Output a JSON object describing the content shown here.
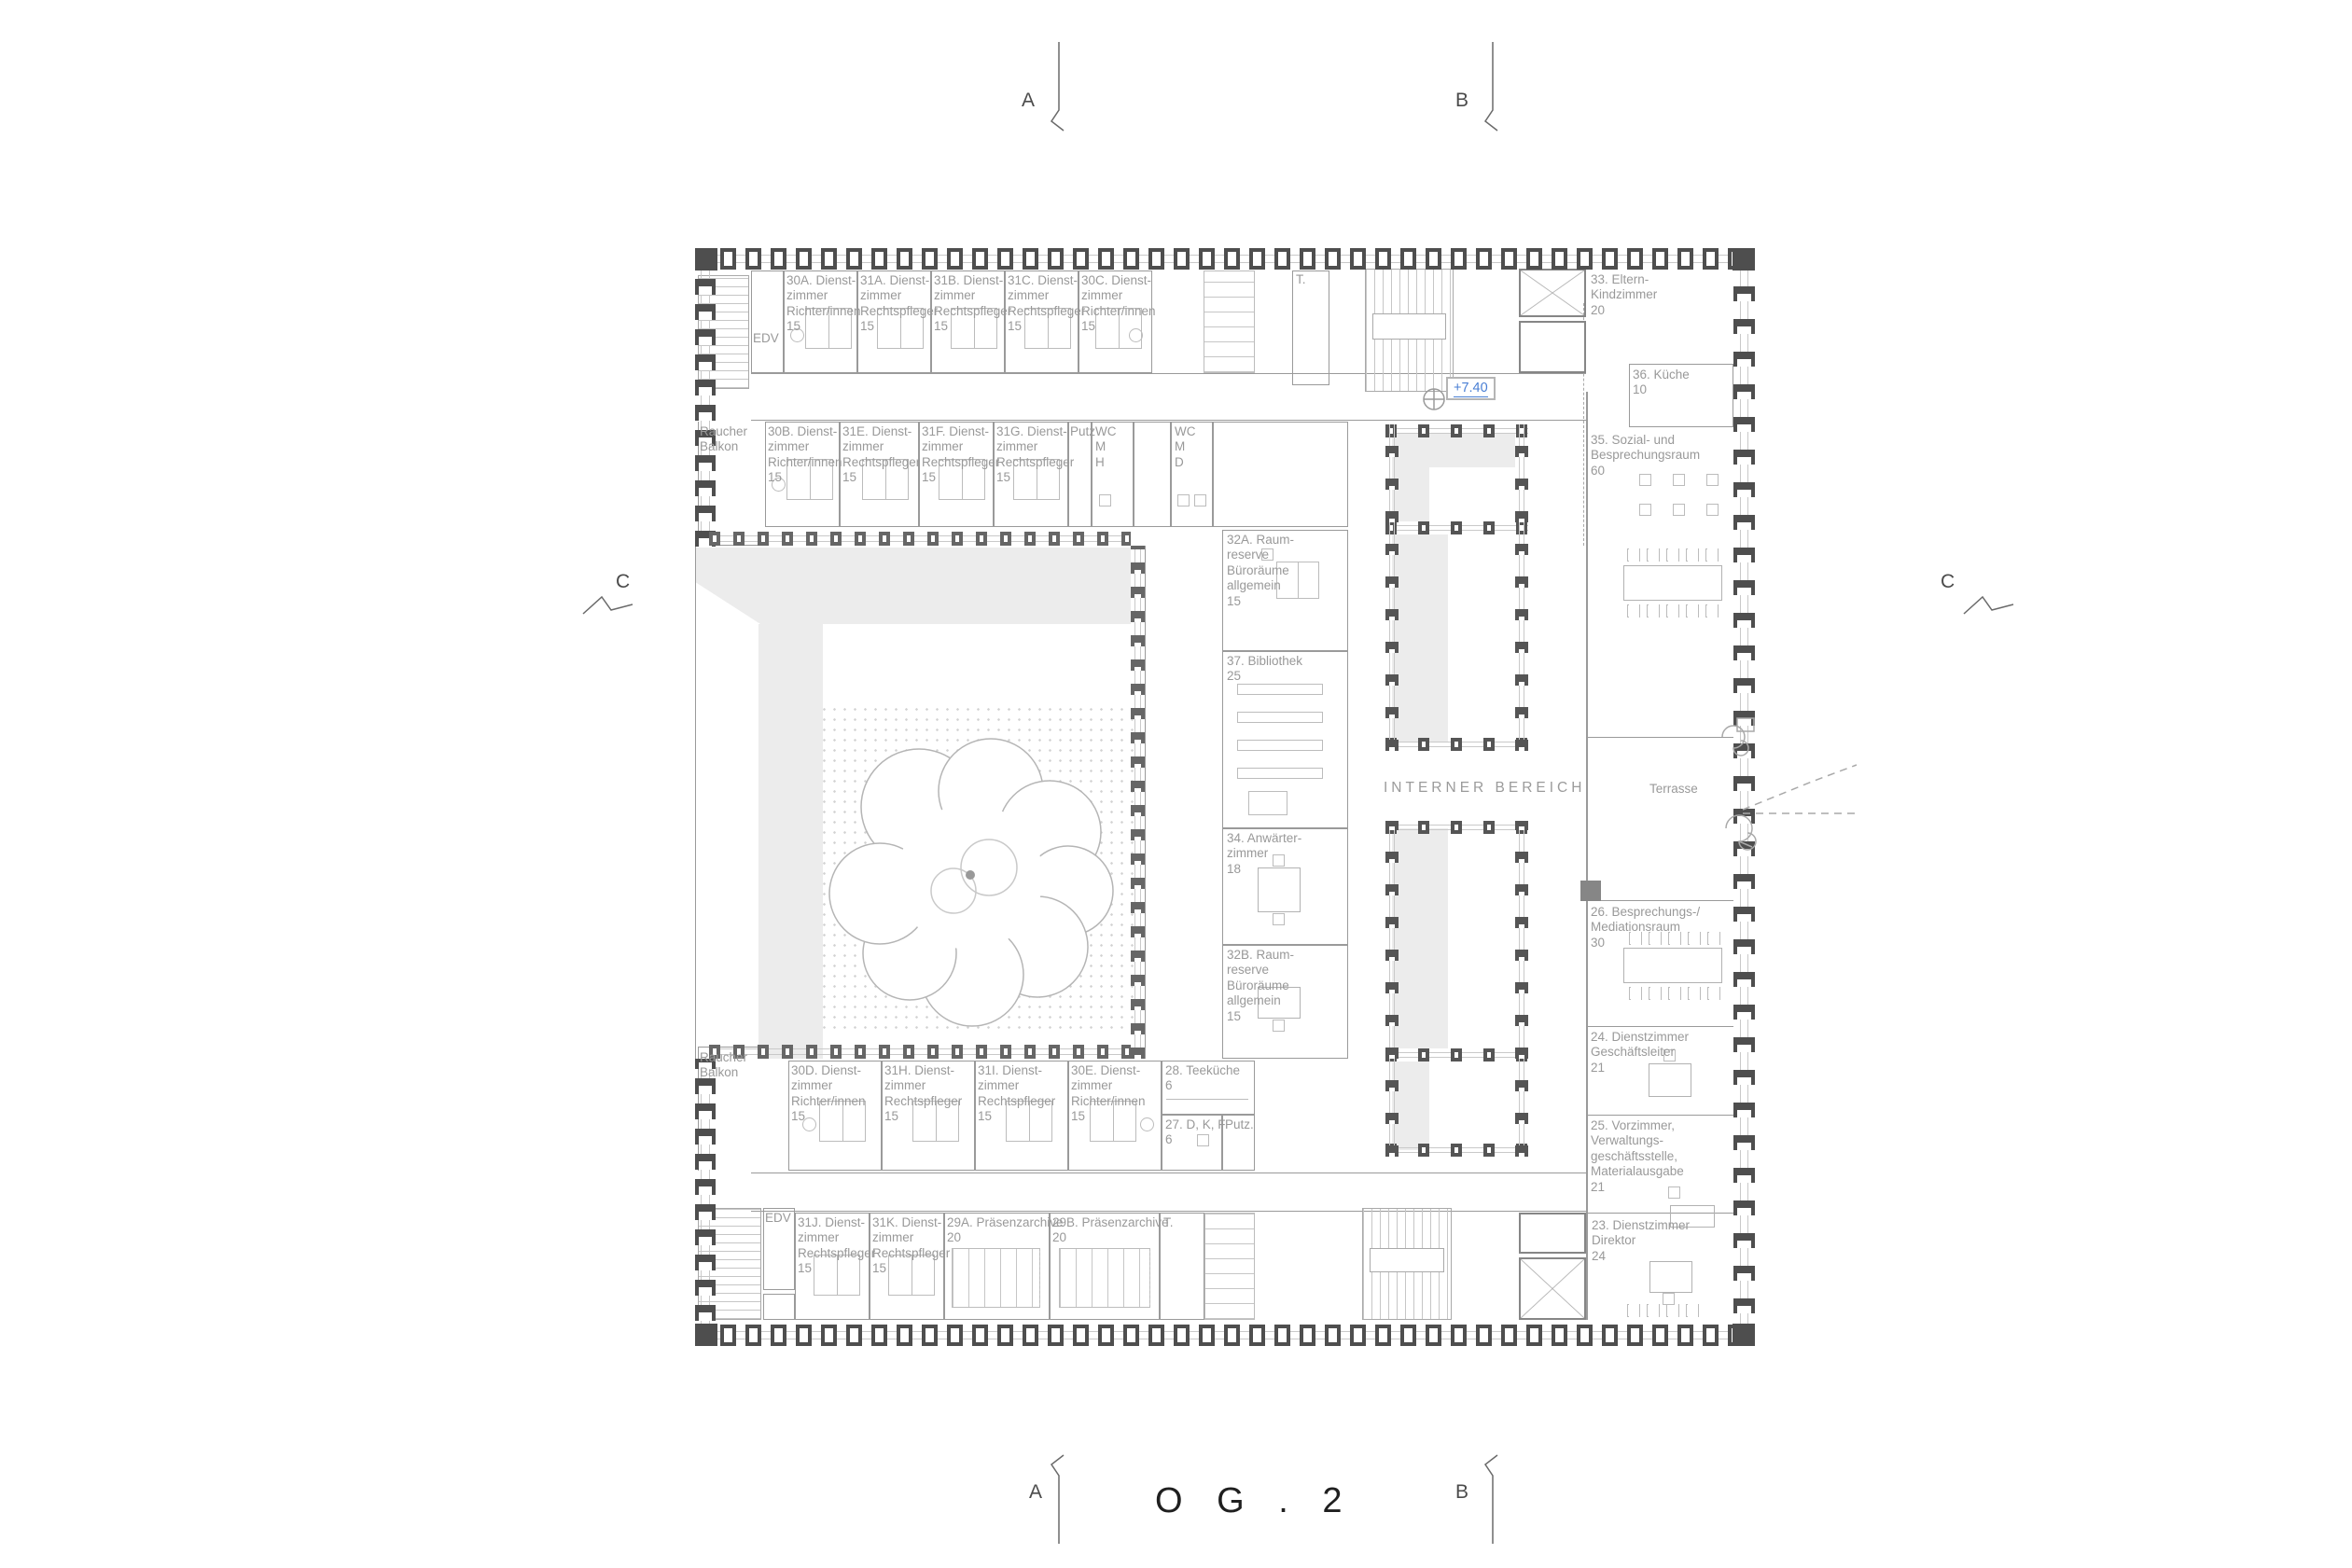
{
  "title": "O G . 2",
  "markers": {
    "elevation": "+7.40",
    "section_a": "A",
    "section_b": "B",
    "section_c": "C"
  },
  "areas": {
    "interner_bereich": "INTERNER BEREICH",
    "terrasse": "Terrasse"
  },
  "rooms": {
    "edv_top": "EDV",
    "r30a": "30A. Dienst-\nzimmer\nRichter/innen\n15",
    "r31a": "31A. Dienst-\nzimmer\nRechtspfleger\n15",
    "r31b": "31B. Dienst-\nzimmer\nRechtspfleger\n15",
    "r31c": "31C. Dienst-\nzimmer\nRechtspfleger\n15",
    "r30c": "30C. Dienst-\nzimmer\nRichter/innen\n15",
    "t_top": "T.",
    "r33": "33. Eltern-\nKindzimmer\n20",
    "raucher_top": "Raucher\nBalkon",
    "r30b": "30B. Dienst-\nzimmer\nRichter/innen\n15",
    "r31e": "31E. Dienst-\nzimmer\nRechtspfleger\n15",
    "r31f": "31F. Dienst-\nzimmer\nRechtspfleger\n15",
    "r31g": "31G. Dienst-\nzimmer\nRechtspfleger\n15",
    "putz_top": "Putz",
    "wc_mh": "WC\nM\nH",
    "wc_md": "WC\nM\nD",
    "r36": "36. Küche\n10",
    "r35": "35. Sozial- und\nBesprechungsraum\n60",
    "r32a": "32A. Raum-\nreserve\nBüroräume\nallgemein\n15",
    "r37": "37. Bibliothek\n25",
    "r34": "34. Anwärter-\nzimmer\n18",
    "r32b": "32B. Raum-\nreserve\nBüroräume\nallgemein\n15",
    "r26": "26. Besprechungs-/\nMediationsraum\n30",
    "r24": "24. Dienstzimmer\nGeschäftsleiter\n21",
    "r25": "25. Vorzimmer,\nVerwaltungs-\ngeschäftsstelle,\nMaterialausgabe\n21",
    "r23": "23. Dienstzimmer\nDirektor\n24",
    "raucher_bottom": "Raucher\nBalkon",
    "r30d": "30D. Dienst-\nzimmer\nRichter/innen\n15",
    "r31h": "31H. Dienst-\nzimmer\nRechtspfleger\n15",
    "r31i": "31I. Dienst-\nzimmer\nRechtspfleger\n15",
    "r30e": "30E. Dienst-\nzimmer\nRichter/innen\n15",
    "r28": "28. Teeküche\n6",
    "r27": "27. D, K, F\n6",
    "putz_bottom": "Putz.",
    "edv_bottom": "EDV",
    "r31j": "31J. Dienst-\nzimmer\nRechtspfleger\n15",
    "r31k": "31K. Dienst-\nzimmer\nRechtspfleger\n15",
    "r29a": "29A. Präsenzarchive\n20",
    "r29b": "29B. Präsenzarchive\n20",
    "t_bottom": "T."
  },
  "colors": {
    "accent_blue": "#4a7fd4",
    "shading_gray": "#ececec",
    "facade_dark": "#4e4e4e",
    "wall_gray": "#9a9a9a"
  }
}
